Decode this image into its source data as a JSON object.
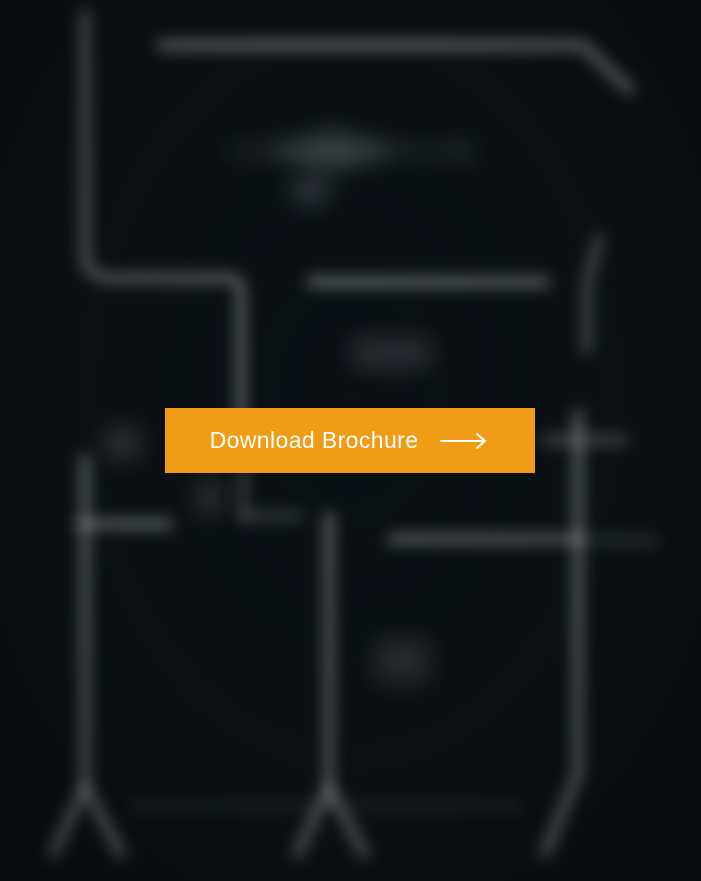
{
  "page": {
    "background": {
      "kind": "blurred-floorplan-drawing",
      "base_color": "#0B1115",
      "line_color": "#CFD4D6"
    }
  },
  "cta": {
    "label": "Download Brochure",
    "icon": "arrow-right",
    "background_color": "#F09C16",
    "text_color": "#FFFFFF"
  }
}
